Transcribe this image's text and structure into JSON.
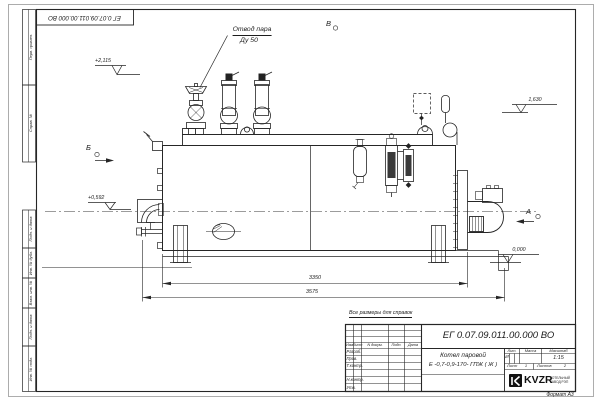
{
  "frame": {
    "top_stamp_number": "ЕГ 0.07.09.011.00.000  ВО",
    "format_label": "Формат А3",
    "margin_labels": [
      "Перв. примен.",
      "Справ. №",
      "Подп. и дата",
      "Инв. № дубл.",
      "Взам. инв. №",
      "Подп. и дата",
      "Инв. № подл."
    ]
  },
  "drawing": {
    "callout_steam_line1": "Отвод пара",
    "callout_steam_line2": "Ду 50",
    "view_b": "Б",
    "view_v": "В",
    "view_a": "А",
    "elev_top": "+2,115",
    "elev_mid": "+0,592",
    "elev_right": "1,630",
    "elev_zero": "0,000",
    "dim_body_length": "3350",
    "dim_overall_length": "3575"
  },
  "title_block": {
    "reference_note": "Все размеры для справок",
    "doc_number": "ЕГ 0.07.09.011.00.000  ВО",
    "product_line1": "Котел паровой",
    "product_line2": "Е -0,7-0,9-170- ГПЖ ( Ж )",
    "col_izm": "Изм",
    "col_list": "Лист",
    "col_doc": "N докум.",
    "col_sign": "Подп.",
    "col_date": "Дата",
    "signature_rows": [
      "Разраб.",
      "Пров.",
      "Т.контр.",
      "Н.контр.",
      "Утв."
    ],
    "lit_label": "Лит.",
    "lit_value": "И",
    "mass_label": "Масса",
    "scale_label": "Масштаб",
    "scale_value": "1:15",
    "sheet_label": "Лист",
    "sheet_value": "1",
    "sheets_label": "Листов",
    "sheets_value": "2",
    "logo_text": "KVZR",
    "logo_sub1": "КОТЕЛЬНЫЙ",
    "logo_sub2": "ЗАВОД РЭП"
  }
}
